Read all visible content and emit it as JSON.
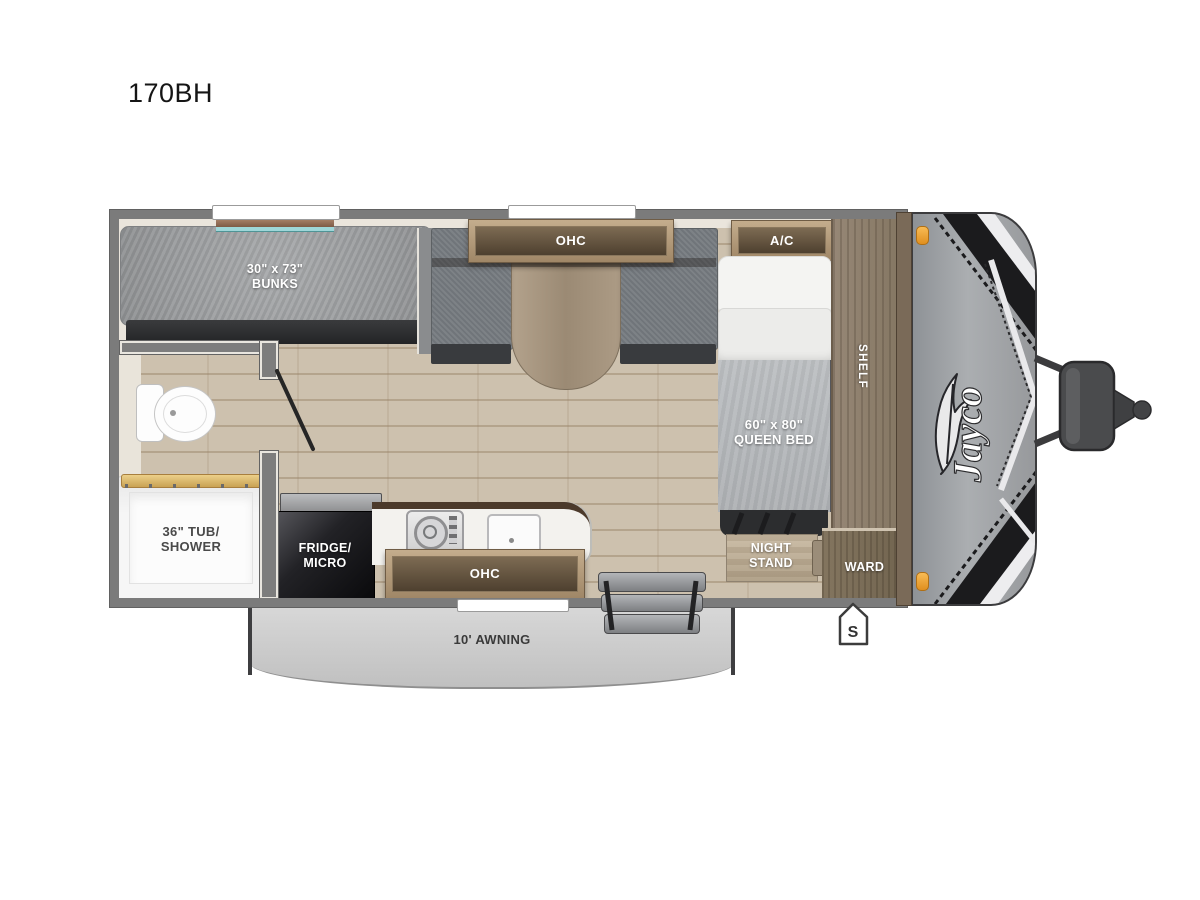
{
  "page": {
    "title": "170BH",
    "brand": "Jayco"
  },
  "labels": {
    "bunks_line1": "30\" x 73\"",
    "bunks_line2": "BUNKS",
    "dinette_ohc": "OHC",
    "ac": "A/C",
    "queen_line1": "60\" x 80\"",
    "queen_line2": "QUEEN BED",
    "shelf": "SHELF",
    "night_stand_line1": "NIGHT",
    "night_stand_line2": "STAND",
    "ward": "WARD",
    "fridge_line1": "FRIDGE/",
    "fridge_line2": "MICRO",
    "kitchen_ohc": "OHC",
    "tub_line1": "36\" TUB/",
    "tub_line2": "SHOWER",
    "awning": "10' AWNING",
    "door_marker": "S"
  },
  "colors": {
    "wall": "#7b7b7b",
    "floor_wood": "#cdc1ae",
    "cabinet_wood": "#a8906f",
    "mattress_gray": "#9fa1a3",
    "bench_gray": "#74797e",
    "bed_blanket": "#b5b8bb",
    "fridge_black": "#17171a",
    "clearance_light_orange": "#f2a43c",
    "awning_gray": "#cccccc",
    "front_cap_gray": "#a2a5a8"
  }
}
